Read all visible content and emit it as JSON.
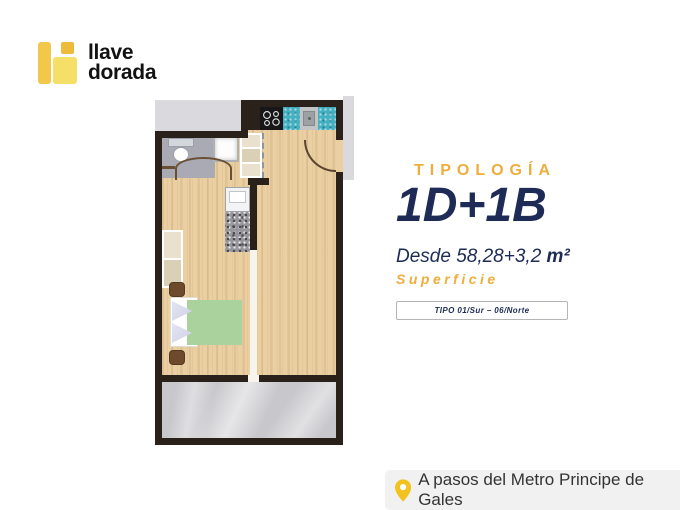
{
  "brand": {
    "name_line1": "llave",
    "name_line2": "dorada"
  },
  "typology": {
    "label": "TIPOLOGÍA",
    "code": "1D+1B",
    "area_text": "Desde 58,28+3,2",
    "area_unit": "m²",
    "area_caption": "Superficie",
    "unit_tag": "TIPO 01/Sur – 06/Norte"
  },
  "footer": {
    "location": "A pasos del Metro Principe de Gales"
  },
  "colors": {
    "gold": "#EFAD3B",
    "navy": "#1D2B56",
    "wall_dark": "#2A211B",
    "wood_floor": "#EACFA2",
    "teal_counter": "#45B0C2",
    "bed_green": "#AAD29C",
    "terrace_marble": "#C8C8CC",
    "exterior_gray": "#DADADE",
    "footer_bg": "#F1F1F2",
    "pin_yellow": "#F2C21F",
    "logo_yellow": "#F1C84B",
    "logo_yellow_light": "#F6DF67",
    "logo_gold": "#EDBA3A"
  },
  "floorplan": {
    "features": [
      "kitchen-cooktop",
      "kitchen-sink",
      "kitchen-counters",
      "bathroom-toilet",
      "bathroom-shower",
      "bathroom-door-arc",
      "entrance-door-arc",
      "wardrobe-cells",
      "washer",
      "granite-counter",
      "bed",
      "pillows",
      "nightstands",
      "terrace"
    ]
  }
}
